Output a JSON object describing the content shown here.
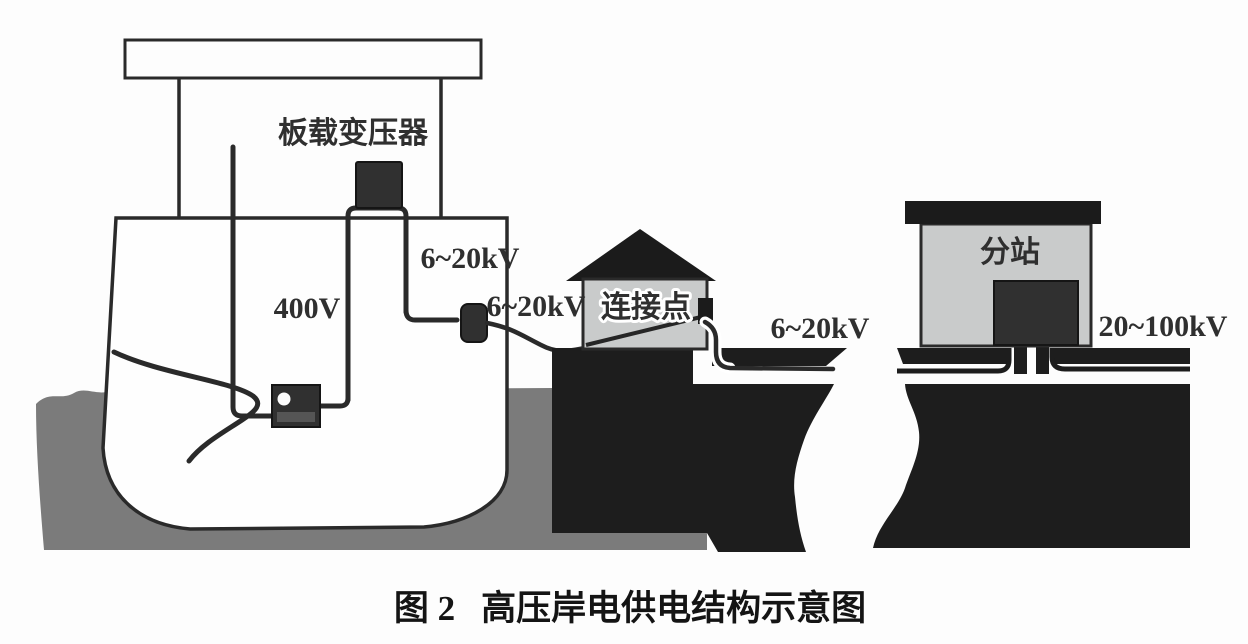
{
  "figure": {
    "caption": {
      "number": "图 2",
      "title": "高压岸电供电结构示意图"
    }
  },
  "ship": {
    "transformer_label": "板载变压器",
    "low_voltage_label": "400V",
    "riser_cable_label": "6~20kV",
    "plug_cable_label": "6~20kV"
  },
  "shore": {
    "connection_point_label": "连接点",
    "buried_cable_label": "6~20kV"
  },
  "substation": {
    "name_label": "分站",
    "grid_voltage_label": "20~100kV"
  },
  "colors": {
    "ground": "#1d1d1d",
    "water": "#7b7b7b",
    "building": "#c9cbcb",
    "line": "#2a2a2a",
    "equipment": "#303030",
    "text": "#2f2f2f"
  }
}
